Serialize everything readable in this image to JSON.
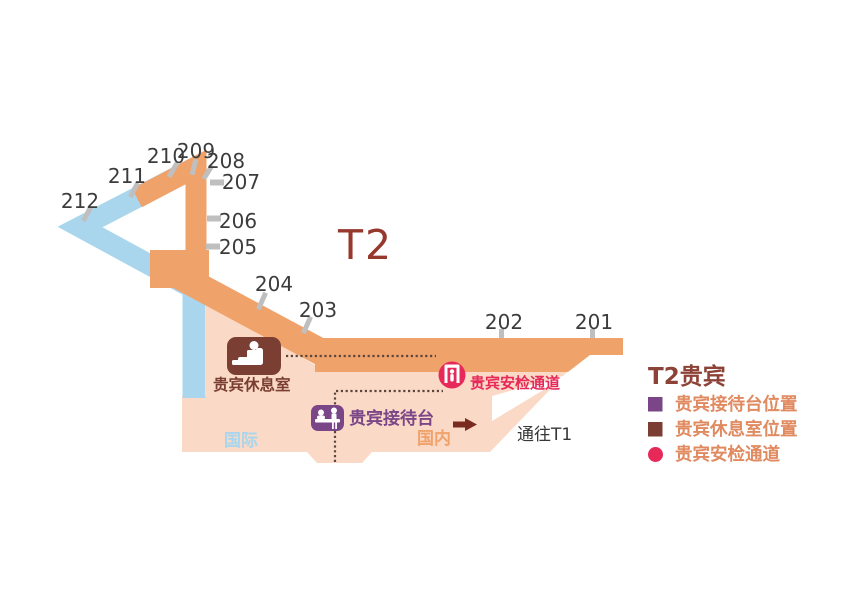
{
  "map": {
    "terminal_title": "T2",
    "gates": [
      "201",
      "202",
      "203",
      "204",
      "205",
      "206",
      "207",
      "208",
      "209",
      "210",
      "211",
      "212"
    ],
    "areas": {
      "international": "国际",
      "domestic": "国内",
      "to_t1": "通往T1"
    },
    "poi": {
      "lounge": "贵宾休息室",
      "reception": "贵宾接待台",
      "security": "贵宾安检通道"
    }
  },
  "legend": {
    "title": "T2贵宾",
    "items": [
      {
        "label": "贵宾接待台位置",
        "marker": "purple-square"
      },
      {
        "label": "贵宾休息室位置",
        "marker": "brown-square"
      },
      {
        "label": "贵宾安检通道",
        "marker": "red-circle"
      }
    ]
  },
  "colors": {
    "terminal_orange": "#F0A26B",
    "wing_blue": "#A9D6ED",
    "apron_peach": "#FAD9C6",
    "lounge_brown": "#7B3E33",
    "reception_purple": "#7A4687",
    "security_red": "#E7295A",
    "title_maroon": "#97382E",
    "legend_text": "#E08A60",
    "tick_gray": "#BFBFBF"
  }
}
